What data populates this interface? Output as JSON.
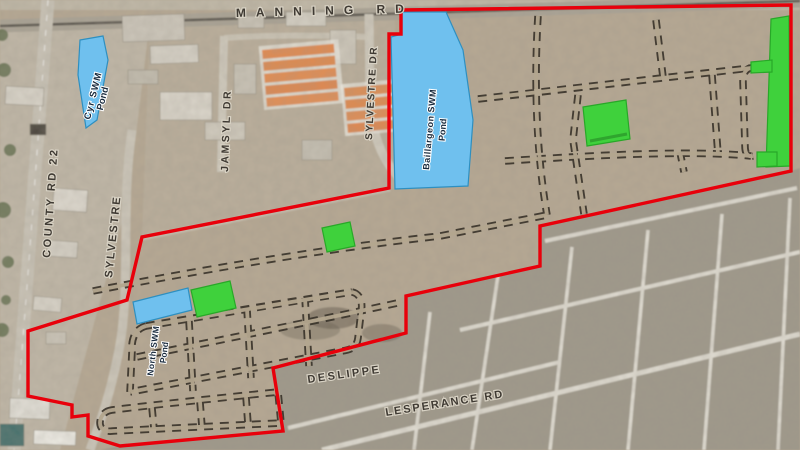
{
  "roads": {
    "manning_rd": "MANNING RD",
    "county_rd_22": "COUNTY RD 22",
    "sylvestre": "SYLVESTRE",
    "sylvestre_dr": "SYLVESTRE DR",
    "jamsyl_dr": "JAMSYL DR",
    "deslippe": "DESLIPPE",
    "lesperance_rd": "LESPERANCE RD"
  },
  "ponds": {
    "cyr": {
      "line1": "Cyr SWM",
      "line2": "Pond"
    },
    "baillargeon": {
      "line1": "Baillargeon SWM",
      "line2": "Pond"
    },
    "north": {
      "line1": "North SWM",
      "line2": "Pond"
    }
  },
  "colors": {
    "boundary_red": "#e8000b",
    "pond_blue": "#6fc0ee",
    "pond_edge": "#2e8fc0",
    "park_green": "#3fd13c",
    "park_edge": "#28a828",
    "proposed_road_dash": "#3b352c"
  }
}
